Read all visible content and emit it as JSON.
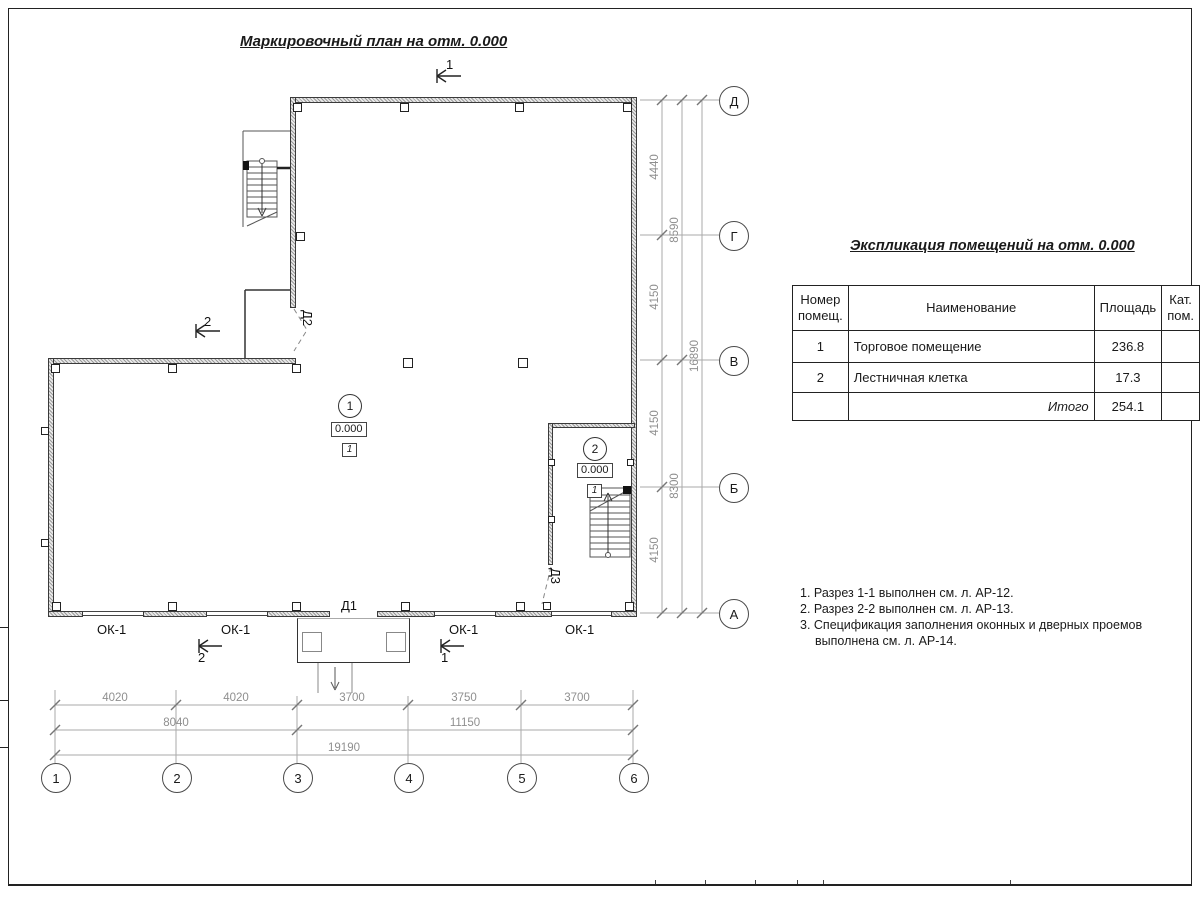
{
  "page": {
    "title": "Маркировочный план на отм. 0.000"
  },
  "axes": {
    "vertical": [
      "Д",
      "Г",
      "В",
      "Б",
      "А"
    ],
    "horizontal": [
      "1",
      "2",
      "3",
      "4",
      "5",
      "6"
    ]
  },
  "dims": {
    "right": {
      "col1": [
        "4440",
        "4150",
        "4150",
        "4150"
      ],
      "col2": [
        "8590",
        "8300"
      ],
      "col3": [
        "16890"
      ]
    },
    "bottom": {
      "row1": [
        "4020",
        "4020",
        "3700",
        "3750",
        "3700"
      ],
      "row2": [
        "8040",
        "11150"
      ],
      "row3": [
        "19190"
      ]
    }
  },
  "plan": {
    "window_label": "ОК-1",
    "doors": {
      "d1": "Д1",
      "d2": "Д2",
      "d3": "Д3"
    },
    "sections": {
      "s1": "1",
      "s2": "2"
    },
    "rooms": [
      {
        "number": "1",
        "elevation": "0.000",
        "floor_type": "1"
      },
      {
        "number": "2",
        "elevation": "0.000",
        "floor_type": "1"
      }
    ]
  },
  "explication": {
    "title": "Экспликация помещений на отм. 0.000",
    "headers": {
      "number": "Номер помещ.",
      "name": "Наименование",
      "area": "Площадь",
      "category": "Кат. пом."
    },
    "rows": [
      {
        "number": "1",
        "name": "Торговое помещение",
        "area": "236.8",
        "category": ""
      },
      {
        "number": "2",
        "name": "Лестничная клетка",
        "area": "17.3",
        "category": ""
      }
    ],
    "total": {
      "label": "Итого",
      "area": "254.1"
    }
  },
  "notes": [
    "1. Разрез 1-1 выполнен см. л. АР-12.",
    "2. Разрез 2-2 выполнен см. л. АР-13.",
    "3. Спецификация заполнения оконных и дверных проемов выполнена см. л. АР-14."
  ]
}
